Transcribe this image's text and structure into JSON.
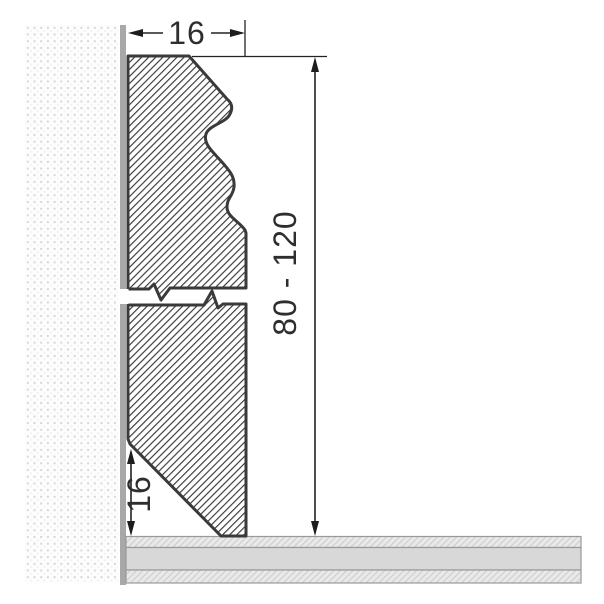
{
  "drawing": {
    "labels": {
      "top_width": "16",
      "height_range": "80 - 120",
      "bottom_height": "16"
    },
    "colors": {
      "outline": "#3a3a3a",
      "profile_hatch_line": "#2f2f2f",
      "wall_dot": "#d7d7d7",
      "wall_surface_strip": "#a8a8a8",
      "floor_middle_gray": "#d8d8d8",
      "floor_hatch_bg": "#e9e9e9",
      "floor_hatch_line": "#cccccc",
      "dimension_ink": "#222222",
      "background": "#ffffff"
    }
  }
}
